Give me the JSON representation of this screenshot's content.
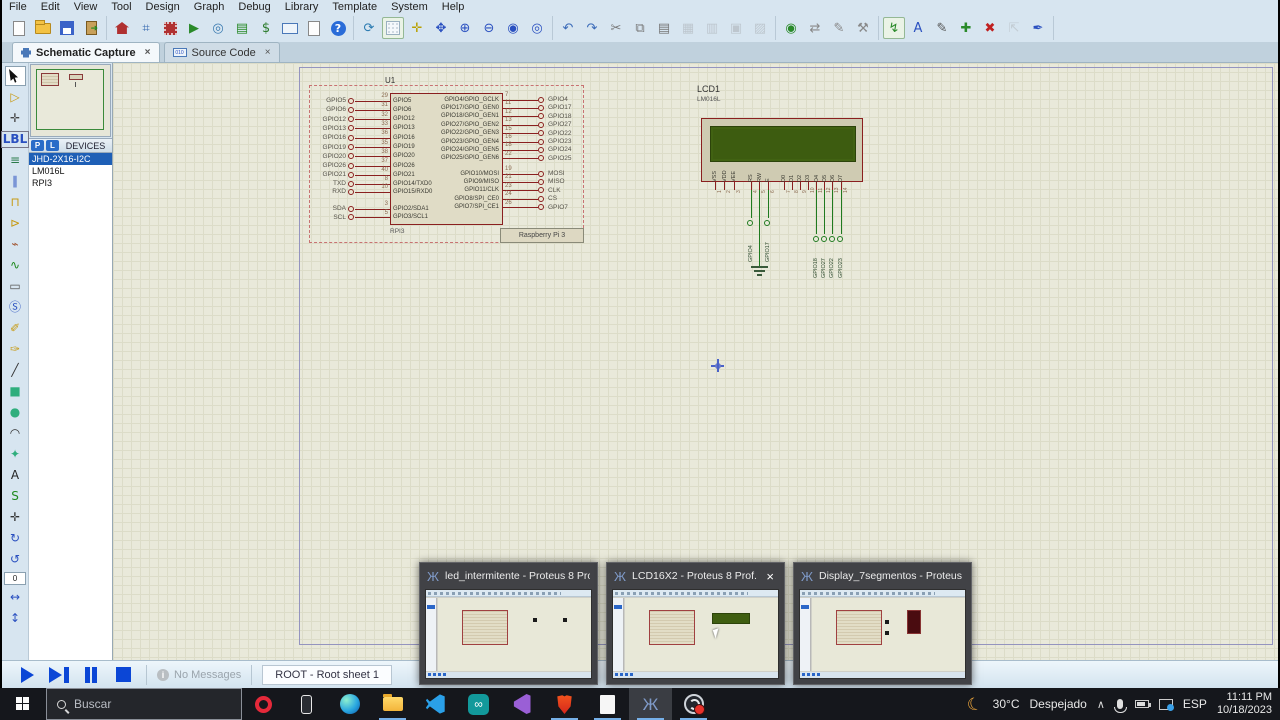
{
  "menu": {
    "items": [
      "File",
      "Edit",
      "View",
      "Tool",
      "Design",
      "Graph",
      "Debug",
      "Library",
      "Template",
      "System",
      "Help"
    ]
  },
  "tabs": [
    {
      "label": "Schematic Capture"
    },
    {
      "label": "Source Code"
    }
  ],
  "toolbar": {
    "groups": [
      [
        {
          "n": "new-design",
          "cls": "ic-paper"
        },
        {
          "n": "open-design",
          "cls": "ic-folder"
        },
        {
          "n": "save-design",
          "cls": "ic-floppy"
        },
        {
          "n": "close-project",
          "cls": "ic-door"
        }
      ],
      [
        {
          "n": "home-page",
          "cls": "ic-home"
        },
        {
          "n": "schematic-capture",
          "g": "⌗",
          "c": "#3468b0"
        },
        {
          "n": "pcb-layout",
          "cls": "ic-chip"
        },
        {
          "n": "3d-visualizer",
          "g": "▶",
          "c": "#2a8a2a"
        },
        {
          "n": "gerber-viewer",
          "g": "◎",
          "c": "#3a7ab0"
        },
        {
          "n": "design-explorer",
          "g": "▤",
          "c": "#2a8a2a"
        },
        {
          "n": "bill-of-materials",
          "g": "$",
          "c": "#2a7a2a"
        },
        {
          "n": "source-code-tool",
          "cls": "ic-010"
        },
        {
          "n": "project-notes",
          "cls": "ic-paper"
        },
        {
          "n": "help",
          "cls": "ic-help",
          "g": "?"
        }
      ],
      [
        {
          "n": "redraw-display",
          "g": "⟳",
          "c": "#2a7ab0"
        },
        {
          "n": "toggle-grid",
          "cls": "ic-grid",
          "on": true
        },
        {
          "n": "false-origin",
          "g": "✛",
          "c": "#b8a000"
        },
        {
          "n": "center-at-cursor",
          "g": "✥",
          "c": "#2a50c0"
        },
        {
          "n": "zoom-in",
          "g": "⊕",
          "c": "#2a50c0"
        },
        {
          "n": "zoom-out",
          "g": "⊖",
          "c": "#2a50c0"
        },
        {
          "n": "zoom-all",
          "g": "◉",
          "c": "#2a50c0"
        },
        {
          "n": "zoom-area",
          "g": "◎",
          "c": "#2a50c0"
        }
      ],
      [
        {
          "n": "undo",
          "g": "↶",
          "c": "#3a6ab8"
        },
        {
          "n": "redo",
          "g": "↷",
          "c": "#3a6ab8"
        },
        {
          "n": "cut",
          "g": "✂",
          "c": "#777"
        },
        {
          "n": "copy",
          "g": "⧉",
          "c": "#777"
        },
        {
          "n": "paste",
          "g": "▤",
          "c": "#777"
        },
        {
          "n": "block-copy",
          "g": "▦",
          "c": "#888",
          "dis": true
        },
        {
          "n": "block-move",
          "g": "▥",
          "c": "#888",
          "dis": true
        },
        {
          "n": "block-rotate",
          "g": "▣",
          "c": "#888",
          "dis": true
        },
        {
          "n": "block-delete",
          "g": "▨",
          "c": "#888",
          "dis": true
        }
      ],
      [
        {
          "n": "pick-parts",
          "g": "◉",
          "c": "#2a8a2a"
        },
        {
          "n": "make-device",
          "g": "⇄",
          "c": "#888"
        },
        {
          "n": "packaging-tool",
          "g": "✎",
          "c": "#888"
        },
        {
          "n": "decompose",
          "g": "⚒",
          "c": "#888"
        }
      ],
      [
        {
          "n": "wire-autorouter",
          "g": "↯",
          "c": "#2a8a2a",
          "on": true
        },
        {
          "n": "search-and-tag",
          "g": "A",
          "c": "#2a50c0"
        },
        {
          "n": "property-assignment-tool",
          "g": "✎",
          "c": "#555"
        },
        {
          "n": "new-root-sheet",
          "g": "✚",
          "c": "#2a8a2a"
        },
        {
          "n": "remove-sheet",
          "g": "✖",
          "c": "#c02020"
        },
        {
          "n": "goto-parent-sheet",
          "g": "⇱",
          "c": "#999",
          "dis": true
        },
        {
          "n": "electrical-rule-check",
          "g": "✒",
          "c": "#2a50c0"
        }
      ]
    ]
  },
  "left_toolbar": {
    "angle": "0",
    "items": [
      {
        "n": "selection-mode",
        "cls": "ic-cursor",
        "on": true
      },
      {
        "n": "component-mode",
        "g": "▷",
        "c": "#c79a12"
      },
      {
        "n": "junction-dot-mode",
        "g": "✛",
        "c": "#444"
      },
      {
        "n": "wire-label-mode",
        "g": "LBL",
        "small": true
      },
      {
        "n": "text-script-mode",
        "g": "≡",
        "c": "#2a7a4a"
      },
      {
        "n": "buses-mode",
        "g": "∥",
        "c": "#2a50c0"
      },
      {
        "n": "subcircuit-mode",
        "g": "⊓",
        "c": "#c79a12"
      },
      {
        "n": "terminals-mode",
        "g": "⊳",
        "c": "#c79a12"
      },
      {
        "n": "device-pins-mode",
        "g": "⌁",
        "c": "#a0522d"
      },
      {
        "n": "graph-mode",
        "g": "∿",
        "c": "#1f8a1f"
      },
      {
        "n": "tape-recorder-mode",
        "g": "▭",
        "c": "#555"
      },
      {
        "n": "generator-mode",
        "g": "Ⓢ",
        "c": "#2a50c0"
      },
      {
        "n": "voltage-probe-mode",
        "g": "✐",
        "c": "#c79a12"
      },
      {
        "n": "current-probe-mode",
        "g": "✑",
        "c": "#c79a12"
      },
      {
        "n": "2d-line-mode",
        "g": "╱",
        "c": "#333"
      },
      {
        "n": "2d-box-mode",
        "g": "■",
        "c": "#2fae7d"
      },
      {
        "n": "2d-circle-mode",
        "g": "●",
        "c": "#2fae7d"
      },
      {
        "n": "2d-arc-mode",
        "g": "◠",
        "c": "#333"
      },
      {
        "n": "2d-path-mode",
        "g": "✦",
        "c": "#2fae7d"
      },
      {
        "n": "2d-text-mode",
        "g": "A",
        "c": "#222"
      },
      {
        "n": "2d-symbol-mode",
        "g": "S",
        "c": "#1f8a1f"
      },
      {
        "n": "2d-marker-mode",
        "g": "✛",
        "c": "#333"
      },
      {
        "n": "rotate-clockwise",
        "g": "↻",
        "c": "#2a50c0"
      },
      {
        "n": "rotate-anticlockwise",
        "g": "↺",
        "c": "#2a50c0"
      },
      {
        "n": "angle-field",
        "field": true
      },
      {
        "n": "x-mirror",
        "g": "↔",
        "c": "#2a50c0"
      },
      {
        "n": "y-mirror",
        "g": "↕",
        "c": "#2a50c0"
      }
    ]
  },
  "devices": {
    "p": "P",
    "l": "L",
    "header": "DEVICES",
    "items": [
      {
        "name": "JHD-2X16-I2C",
        "selected": true
      },
      {
        "name": "LM016L",
        "selected": false
      },
      {
        "name": "RPI3",
        "selected": false
      }
    ]
  },
  "schematic": {
    "u1": {
      "ref": "U1",
      "value": "RPI3",
      "part_label": "Raspberry Pi 3",
      "left_pins": [
        {
          "term": "GPIO5",
          "num": "29",
          "inner": "GPIO5"
        },
        {
          "term": "GPIO6",
          "num": "31",
          "inner": "GPIO6"
        },
        {
          "term": "GPIO12",
          "num": "32",
          "inner": "GPIO12"
        },
        {
          "term": "GPIO13",
          "num": "33",
          "inner": "GPIO13"
        },
        {
          "term": "GPIO16",
          "num": "36",
          "inner": "GPIO16"
        },
        {
          "term": "GPIO19",
          "num": "35",
          "inner": "GPIO19"
        },
        {
          "term": "GPIO20",
          "num": "38",
          "inner": "GPIO20"
        },
        {
          "term": "GPIO26",
          "num": "37",
          "inner": "GPIO26"
        },
        {
          "term": "GPIO21",
          "num": "40",
          "inner": "GPIO21"
        },
        {
          "term": "TXD",
          "num": "8",
          "inner": "GPIO14/TXD0"
        },
        {
          "term": "RXD",
          "num": "10",
          "inner": "GPIO15/RXD0"
        },
        {
          "term": "SDA",
          "num": "3",
          "inner": "GPIO2/SDA1"
        },
        {
          "term": "SCL",
          "num": "5",
          "inner": "GPIO3/SCL1"
        }
      ],
      "right_pins": [
        {
          "inner": "GPIO4/GPIO_GCLK",
          "num": "7",
          "term": "GPIO4"
        },
        {
          "inner": "GPIO17/GPIO_GEN0",
          "num": "11",
          "term": "GPIO17"
        },
        {
          "inner": "GPIO18/GPIO_GEN1",
          "num": "12",
          "term": "GPIO18"
        },
        {
          "inner": "GPIO27/GPIO_GEN2",
          "num": "13",
          "term": "GPIO27"
        },
        {
          "inner": "GPIO22/GPIO_GEN3",
          "num": "15",
          "term": "GPIO22"
        },
        {
          "inner": "GPIO23/GPIO_GEN4",
          "num": "16",
          "term": "GPIO23"
        },
        {
          "inner": "GPIO24/GPIO_GEN5",
          "num": "18",
          "term": "GPIO24"
        },
        {
          "inner": "GPIO25/GPIO_GEN6",
          "num": "22",
          "term": "GPIO25"
        },
        {
          "inner": "GPIO10/MOSI",
          "num": "19",
          "term": "MOSI"
        },
        {
          "inner": "GPIO9/MISO",
          "num": "21",
          "term": "MISO"
        },
        {
          "inner": "GPIO11/CLK",
          "num": "23",
          "term": "CLK"
        },
        {
          "inner": "GPIO8/SPI_CE0",
          "num": "24",
          "term": "CS"
        },
        {
          "inner": "GPIO7/SPI_CE1",
          "num": "26",
          "term": "GPIO7"
        }
      ]
    },
    "lcd": {
      "ref": "LCD1",
      "value": "LM016L",
      "pins": [
        "VSS",
        "VDD",
        "VEE",
        "RS",
        "RW",
        "E",
        "D0",
        "D1",
        "D2",
        "D3",
        "D4",
        "D5",
        "D6",
        "D7"
      ],
      "terminals": [
        {
          "pin": "RS",
          "label": "GPIO4"
        },
        {
          "pin": "E",
          "label": "GPIO17"
        },
        {
          "pin": "D4",
          "label": "GPIO18"
        },
        {
          "pin": "D5",
          "label": "GPIO27"
        },
        {
          "pin": "D6",
          "label": "GPIO22"
        },
        {
          "pin": "D7",
          "label": "GPIO23"
        }
      ],
      "ground_pin": "RW"
    }
  },
  "statusbar": {
    "no_messages": "No Messages",
    "root": "ROOT - Root sheet 1"
  },
  "previews": [
    {
      "title": "led_intermitente - Proteus 8 Pro...",
      "variant": "leds",
      "close": false
    },
    {
      "title": "LCD16X2 - Proteus 8 Prof...",
      "variant": "lcd",
      "close": true
    },
    {
      "title": "Display_7segmentos - Proteus 8...",
      "variant": "7seg",
      "close": false
    }
  ],
  "taskbar": {
    "search_placeholder": "Buscar",
    "icons": [
      {
        "n": "opera",
        "cls": "tb-opera",
        "open": false
      },
      {
        "n": "phone-link",
        "cls": "tb-phone",
        "open": false
      },
      {
        "n": "edge",
        "cls": "tb-edge",
        "open": false
      },
      {
        "n": "file-explorer",
        "cls": "tb-folder",
        "open": true
      },
      {
        "n": "vscode",
        "cls": "tb-vscode",
        "open": false
      },
      {
        "n": "arduino-ide",
        "cls": "tb-arduino",
        "g": "∞",
        "open": false
      },
      {
        "n": "visual-studio",
        "cls": "tb-vs",
        "open": false
      },
      {
        "n": "brave",
        "cls": "tb-brave",
        "open": true
      },
      {
        "n": "notepad",
        "cls": "tb-notepad",
        "open": true
      },
      {
        "n": "proteus",
        "cls": "tb-proteus",
        "g": "Ж",
        "open": true,
        "active": true
      },
      {
        "n": "obs-studio",
        "cls": "tb-obs",
        "open": true
      }
    ],
    "tray": {
      "weather_temp": "30°C",
      "weather_desc": "Despejado",
      "chevron": "∧",
      "lang": "ESP",
      "time": "11:11 PM",
      "date": "10/18/2023"
    }
  }
}
